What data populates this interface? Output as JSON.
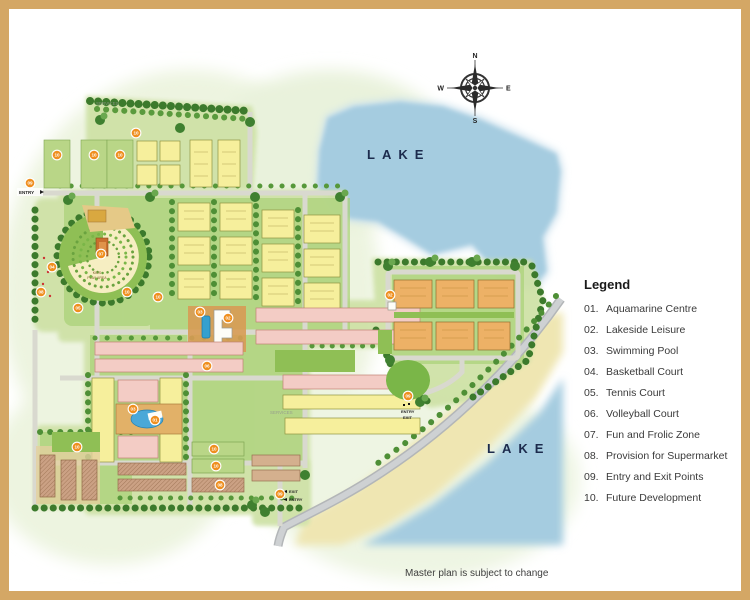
{
  "note": "Master plan is subject to change",
  "lakes": {
    "top_label": "LAKE",
    "bottom_label": "LAKE"
  },
  "compass": {
    "n": "N",
    "e": "E",
    "s": "S",
    "w": "W"
  },
  "legend": {
    "title": "Legend",
    "items": [
      {
        "num": "01.",
        "label": "Aquamarine Centre"
      },
      {
        "num": "02.",
        "label": "Lakeside Leisure"
      },
      {
        "num": "03.",
        "label": "Swimming Pool"
      },
      {
        "num": "04.",
        "label": "Basketball Court"
      },
      {
        "num": "05.",
        "label": "Tennis Court"
      },
      {
        "num": "06.",
        "label": "Volleyball Court"
      },
      {
        "num": "07.",
        "label": "Fun and Frolic Zone"
      },
      {
        "num": "08.",
        "label": "Provision for Supermarket"
      },
      {
        "num": "09.",
        "label": "Entry and Exit Points"
      },
      {
        "num": "10.",
        "label": "Future Development"
      }
    ]
  },
  "map_labels": {
    "entry_left": "ENTRY",
    "services_top": "SERVICES",
    "services_mid": "SERVICES",
    "kids_line1": "KIDS",
    "kids_line2": "PLAY AREA",
    "entry_exit_right_1": "ENTRY",
    "entry_exit_right_2": "EXIT",
    "exit_bottom_1": "EXIT",
    "exit_bottom_2": "ENTRY"
  },
  "markers": [
    "09",
    "10",
    "10",
    "10",
    "10",
    "07",
    "04",
    "08",
    "05",
    "10",
    "10",
    "03",
    "02",
    "06",
    "02",
    "09",
    "03",
    "01",
    "10",
    "10",
    "08",
    "10",
    "09"
  ],
  "colors": {
    "frame_tan": "#d4a765",
    "lake_blue": "#a5cce0",
    "sand": "#efe6b2",
    "marker_orange": "#ef8f1f",
    "road_gray": "#b3b6b8",
    "lawn_green": "#8fbf55",
    "building_yellow": "#f6ef9c",
    "building_pink": "#f3ccc5",
    "building_orange": "#edb166"
  }
}
